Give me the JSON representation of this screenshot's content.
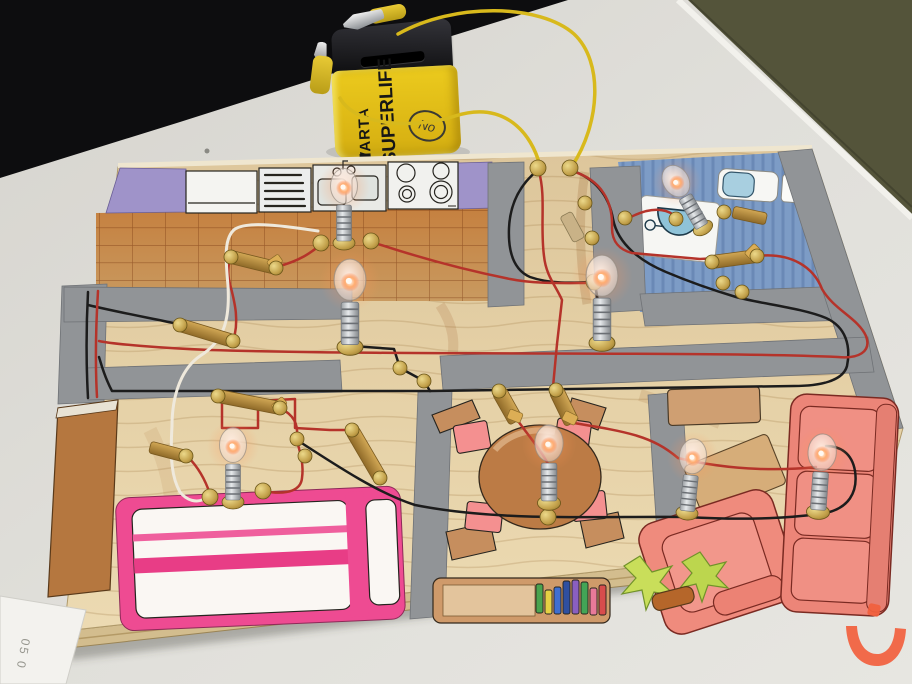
{
  "scene": {
    "description": "Hand-built electric circuit model: house floor plan drawn and coloured on a plywood board, with eight lit miniature bulbs, copper-strip switches, brass paper-fastener contacts and wire runs, powered by a flat battery with crocodile clips.",
    "battery": {
      "brand": "VARTA",
      "model": "SUPERLIFE",
      "handwritten_mark": "No",
      "body_color": "#e6c31e",
      "top_color": "#1a1a1c",
      "clip_wire_color": "#d8b91c"
    },
    "board": {
      "rooms": [
        "kitchen",
        "bathroom",
        "hallway",
        "bedroom",
        "dining-room",
        "living-room"
      ],
      "bulbs_lit": 8,
      "contact_type": "brass paper fasteners",
      "switch_type": "copper strip switches",
      "wire_colors": {
        "red": "#b5332a",
        "black": "#1c1c1c",
        "white": "#efe9dc",
        "yellow": "#d8b91c"
      }
    },
    "paper_note": {
      "text": "05 0"
    },
    "watermark": {
      "glyph": "ن",
      "color": "#f2603d"
    },
    "palette": {
      "table": "#dedcd6",
      "background_dark": "#0d0d0f",
      "background_olive": "#54543a",
      "board_wood": "#e2cda2",
      "kitchen_tile": "#c5803f",
      "bathroom_floor": "#7d9cc6",
      "wall_gray": "#919497",
      "wall_purple": "#9f93c9",
      "bed_pink": "#ee4b92",
      "sofa_salmon": "#ef8b7d",
      "furniture_brown": "#bc7b45",
      "brass": "#c9a84c"
    }
  }
}
